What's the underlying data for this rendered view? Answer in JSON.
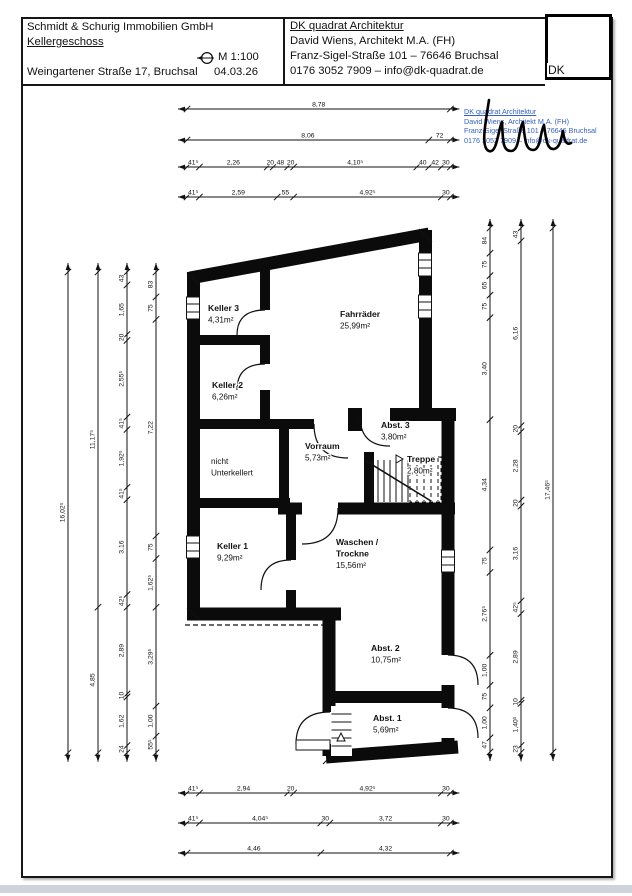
{
  "title_block": {
    "client": "Schmidt & Schurig Immobilien GmbH",
    "floor": "Kellergeschoss",
    "address": "Weingartener Straße 17, Bruchsal",
    "scale": "M 1:100",
    "date": "04.03.26",
    "architect": {
      "firm": "DK quadrat Architektur",
      "name": "David Wiens, Architekt M.A. (FH)",
      "street": "Franz-Sigel-Straße 101 – 76646 Bruchsal",
      "contact": "0176 3052 7909 – info@dk-quadrat.de"
    },
    "stamp_initials": "DK"
  },
  "stamp": {
    "lines": [
      "DK quadrat Architektur",
      "David Wiens, Architekt M.A. (FH)",
      "Franz-Sigel-Straße 101 – 76646 Bruchsal",
      "0176 3052 7909 – info@dk-quadrat.de"
    ]
  },
  "colors": {
    "wall_black": "#0b0b0b",
    "stamp_blue": "#3660bf",
    "footer_gray": "#cfd4dc"
  },
  "plan": {
    "rooms": [
      {
        "lines": [
          "Keller 3",
          "4,31m²"
        ],
        "bold": 1,
        "x": 208,
        "y": 311
      },
      {
        "lines": [
          "Fahrräder",
          "25,99m²"
        ],
        "bold": 1,
        "x": 340,
        "y": 317
      },
      {
        "lines": [
          "Keller 2",
          "6,26m²"
        ],
        "bold": 1,
        "x": 212,
        "y": 388
      },
      {
        "lines": [
          "nicht",
          "Unterkellert"
        ],
        "bold": 0,
        "x": 211,
        "y": 464
      },
      {
        "lines": [
          "Vorraum",
          "5,73m²"
        ],
        "bold": 1,
        "x": 305,
        "y": 449
      },
      {
        "lines": [
          "Abst. 3",
          "3,80m²"
        ],
        "bold": 1,
        "x": 381,
        "y": 428
      },
      {
        "lines": [
          "Treppe",
          "2,80m²"
        ],
        "bold": 1,
        "x": 407,
        "y": 462,
        "arrow": true
      },
      {
        "lines": [
          "Keller 1",
          "9,29m²"
        ],
        "bold": 1,
        "x": 217,
        "y": 549
      },
      {
        "lines": [
          "Waschen /",
          "Trockne",
          "15,56m²"
        ],
        "bold": 2,
        "x": 336,
        "y": 545
      },
      {
        "lines": [
          "Abst. 2",
          "10,75m²"
        ],
        "bold": 1,
        "x": 371,
        "y": 651
      },
      {
        "lines": [
          "Abst. 1",
          "5,69m²"
        ],
        "bold": 1,
        "x": 373,
        "y": 721
      }
    ]
  },
  "dimensions": {
    "top": [
      {
        "pos": 109,
        "start": 187,
        "segments": [
          {
            "label": "8,78",
            "px": 263.4
          }
        ]
      },
      {
        "pos": 140,
        "start": 187,
        "segments": [
          {
            "label": "8,06",
            "px": 241.8
          },
          {
            "label": "72",
            "px": 21.6
          }
        ]
      },
      {
        "pos": 167,
        "start": 187,
        "segments": [
          {
            "label": "41⁵",
            "px": 12.45
          },
          {
            "label": "2,26",
            "px": 67.8
          },
          {
            "label": "20",
            "px": 6
          },
          {
            "label": "48",
            "px": 14.4
          },
          {
            "label": "20",
            "px": 6
          },
          {
            "label": "4,10⁵",
            "px": 123.15
          },
          {
            "label": "40",
            "px": 12
          },
          {
            "label": "42",
            "px": 12.6
          },
          {
            "label": "30",
            "px": 9
          }
        ]
      },
      {
        "pos": 197,
        "start": 187,
        "segments": [
          {
            "label": "41⁵",
            "px": 12.45
          },
          {
            "label": "2,59",
            "px": 77.7
          },
          {
            "label": "55",
            "px": 16.5
          },
          {
            "label": "4,92⁵",
            "px": 147.75
          },
          {
            "label": "30",
            "px": 9
          }
        ]
      }
    ],
    "bottom": [
      {
        "pos": 793,
        "start": 187,
        "segments": [
          {
            "label": "41⁵",
            "px": 12.45
          },
          {
            "label": "2,94",
            "px": 88.2
          },
          {
            "label": "20",
            "px": 6
          },
          {
            "label": "4,92⁵",
            "px": 147.75
          },
          {
            "label": "30",
            "px": 9
          }
        ]
      },
      {
        "pos": 823,
        "start": 187,
        "segments": [
          {
            "label": "41⁵",
            "px": 12.45
          },
          {
            "label": "4,04⁵",
            "px": 121.35
          },
          {
            "label": "30",
            "px": 9
          },
          {
            "label": "3,72",
            "px": 111.6
          },
          {
            "label": "30",
            "px": 9
          }
        ]
      },
      {
        "pos": 853,
        "start": 187,
        "segments": [
          {
            "label": "4,46",
            "px": 133.8
          },
          {
            "label": "4,32",
            "px": 129.6
          }
        ]
      }
    ],
    "left": [
      {
        "pos": 68,
        "start": 272,
        "segments": [
          {
            "label": "16,02⁵",
            "px": 480.75
          }
        ]
      },
      {
        "pos": 98,
        "start": 272,
        "segments": [
          {
            "label": "11,17⁵",
            "px": 335.25
          },
          {
            "label": "4,85",
            "px": 145.5
          }
        ]
      },
      {
        "pos": 127,
        "start": 272,
        "segments": [
          {
            "label": "43",
            "px": 12.9
          },
          {
            "label": "1,65",
            "px": 49.5
          },
          {
            "label": "20",
            "px": 6
          },
          {
            "label": "2,55⁵",
            "px": 76.65
          },
          {
            "label": "41⁵",
            "px": 12.45
          },
          {
            "label": "1,92⁵",
            "px": 57.75
          },
          {
            "label": "41⁵",
            "px": 12.45
          },
          {
            "label": "3,16",
            "px": 94.8
          },
          {
            "label": "42⁵",
            "px": 12.75
          },
          {
            "label": "2,89",
            "px": 86.7
          },
          {
            "label": "10",
            "px": 3
          },
          {
            "label": "1,62",
            "px": 48.6
          },
          {
            "label": "24",
            "px": 7.2
          }
        ]
      },
      {
        "pos": 156,
        "start": 272,
        "segments": [
          {
            "label": "83",
            "px": 24.9
          },
          {
            "label": "75",
            "px": 22.5
          },
          {
            "label": "7,22",
            "px": 216.6
          },
          {
            "label": "75",
            "px": 22.5
          },
          {
            "label": "1,62⁵",
            "px": 48.75
          },
          {
            "label": "3,29⁵",
            "px": 98.85
          },
          {
            "label": "1,00",
            "px": 30
          },
          {
            "label": "55⁵",
            "px": 16.65
          }
        ]
      }
    ],
    "right": [
      {
        "pos": 490,
        "start": 228,
        "segments": [
          {
            "label": "84",
            "px": 25.2
          },
          {
            "label": "75",
            "px": 22.5
          },
          {
            "label": "65",
            "px": 19.5
          },
          {
            "label": "75",
            "px": 22.5
          },
          {
            "label": "3,40",
            "px": 102
          },
          {
            "label": "4,34",
            "px": 130.2
          },
          {
            "label": "75",
            "px": 22.5
          },
          {
            "label": "2,76⁵",
            "px": 82.95
          },
          {
            "label": "1,00",
            "px": 30
          },
          {
            "label": "75",
            "px": 22.5
          },
          {
            "label": "1,00",
            "px": 30
          },
          {
            "label": "47",
            "px": 14.1
          }
        ]
      },
      {
        "pos": 521,
        "start": 228,
        "segments": [
          {
            "label": "43",
            "px": 12.9
          },
          {
            "label": "6,16",
            "px": 184.8
          },
          {
            "label": "20",
            "px": 6
          },
          {
            "label": "2,28",
            "px": 68.4
          },
          {
            "label": "20",
            "px": 6
          },
          {
            "label": "3,16",
            "px": 94.8
          },
          {
            "label": "42⁵",
            "px": 12.75
          },
          {
            "label": "2,89",
            "px": 86.7
          },
          {
            "label": "10",
            "px": 3
          },
          {
            "label": "1,40⁵",
            "px": 42.15
          },
          {
            "label": "23",
            "px": 6.9
          }
        ]
      },
      {
        "pos": 553,
        "start": 228,
        "segments": [
          {
            "label": "17,46⁵",
            "px": 523.95
          }
        ]
      }
    ]
  }
}
